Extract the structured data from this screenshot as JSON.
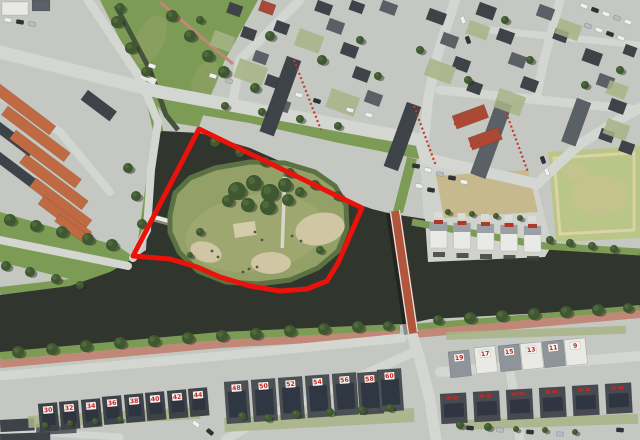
{
  "map": {
    "kind": "aerial-photograph",
    "palette": {
      "road": "#c5c8c2",
      "road_light": "#d4d6d1",
      "water": "#30352e",
      "grass": "#7c9b55",
      "grass_dark": "#5e8043",
      "island_grass": "#93a168",
      "dry_grass": "#a9ad78",
      "sand": "#d0c6a3",
      "tree": "#3f5831",
      "brick_path": "#c28877",
      "bridge_deck": "#b2553f",
      "roof_dark": "#3e4349",
      "roof_slate": "#5a6066",
      "roof_orange": "#bf6a42",
      "roof_red": "#a84a35",
      "house_white": "#e9e9e5",
      "field_beige": "#c6b98e",
      "field_light": "#bac687",
      "solar": "#2c3440",
      "garden": "#a7b487",
      "land_pale": "#d0d2cc",
      "placard_bg": "#f5f5f1",
      "placard_text": "#c8201c",
      "annotation": "#ea120b",
      "car_white": "#eef0ee",
      "car_dark": "#2f3339",
      "car_silver": "#b8bcc0"
    },
    "annotation": {
      "label": "highlighted-parcel-outline",
      "color": "#ea120b",
      "stroke_width": 5,
      "points": [
        [
          199,
          129
        ],
        [
          362,
          208
        ],
        [
          338,
          263
        ],
        [
          327,
          281
        ],
        [
          307,
          289
        ],
        [
          280,
          291
        ],
        [
          250,
          286
        ],
        [
          220,
          277
        ],
        [
          197,
          267
        ],
        [
          170,
          259
        ],
        [
          133,
          256
        ]
      ]
    },
    "house_numbers": {
      "row_left": [
        "30",
        "32",
        "34",
        "36",
        "38",
        "40",
        "42",
        "44"
      ],
      "row_middle": [
        "48",
        "50",
        "52",
        "54",
        "56",
        "58",
        "60"
      ],
      "row_right": [
        "19",
        "17",
        "15",
        "13",
        "11",
        "9"
      ]
    }
  }
}
